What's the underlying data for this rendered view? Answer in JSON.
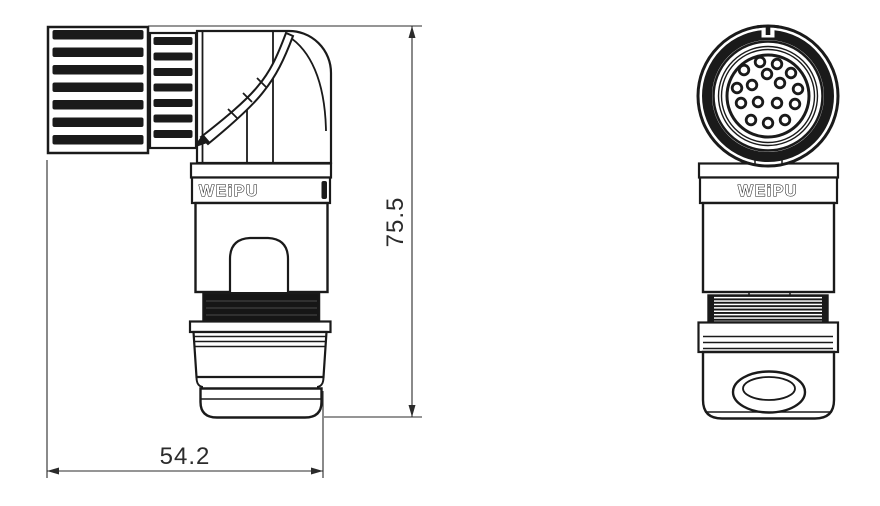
{
  "brand": "WEiPU",
  "dimensions": {
    "width_mm": "54.2",
    "height_mm": "75.5"
  },
  "front_view": {
    "pin_count": 16,
    "pins": [
      [
        -8,
        -34
      ],
      [
        9,
        -32
      ],
      [
        -24,
        -26
      ],
      [
        23,
        -23
      ],
      [
        -1,
        -22
      ],
      [
        -31,
        -8
      ],
      [
        -16,
        -11
      ],
      [
        12,
        -13
      ],
      [
        30,
        -7
      ],
      [
        -27,
        7
      ],
      [
        -10,
        6
      ],
      [
        9,
        7
      ],
      [
        27,
        8
      ],
      [
        -17,
        24
      ],
      [
        0,
        27
      ],
      [
        17,
        24
      ]
    ]
  },
  "colors": {
    "line": "#1a1a1a",
    "dim": "#2b2b2b",
    "background": "#ffffff",
    "thread": "#161616"
  }
}
